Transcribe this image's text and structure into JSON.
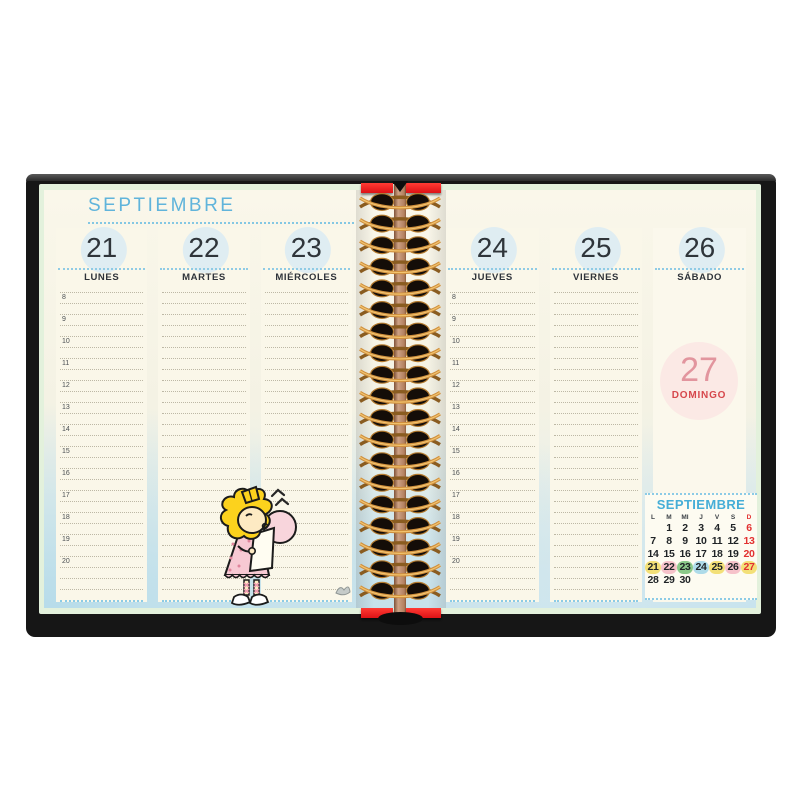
{
  "month_title": "SEPTIEMBRE",
  "left_page": {
    "days": [
      {
        "number": "21",
        "name": "LUNES",
        "has_rules": true,
        "shows_hours": true
      },
      {
        "number": "22",
        "name": "MARTES",
        "has_rules": true,
        "shows_hours": false
      },
      {
        "number": "23",
        "name": "MIÉRCOLES",
        "has_rules": true,
        "shows_hours": false
      }
    ]
  },
  "right_page": {
    "days": [
      {
        "number": "24",
        "name": "JUEVES",
        "has_rules": true,
        "shows_hours": true
      },
      {
        "number": "25",
        "name": "VIERNES",
        "has_rules": true,
        "shows_hours": false
      },
      {
        "number": "26",
        "name": "SÁBADO",
        "has_rules": false,
        "shows_hours": false
      }
    ],
    "sunday": {
      "number": "27",
      "name": "DOMINGO"
    }
  },
  "hours": [
    "8",
    "9",
    "10",
    "11",
    "12",
    "13",
    "14",
    "15",
    "16",
    "17",
    "18",
    "19",
    "20"
  ],
  "mini_calendar": {
    "title": "SEPTIEMBRE",
    "weekday_headers": [
      "L",
      "M",
      "MI",
      "J",
      "V",
      "S",
      "D"
    ],
    "weeks": [
      [
        "",
        "1",
        "2",
        "3",
        "4",
        "5",
        "6"
      ],
      [
        "7",
        "8",
        "9",
        "10",
        "11",
        "12",
        "13"
      ],
      [
        "14",
        "15",
        "16",
        "17",
        "18",
        "19",
        "20"
      ],
      [
        "21",
        "22",
        "23",
        "24",
        "25",
        "26",
        "27"
      ],
      [
        "28",
        "29",
        "30",
        "",
        "",
        "",
        ""
      ]
    ],
    "highlights": {
      "21": "yellow",
      "22": "pink",
      "23": "green",
      "24": "blue",
      "25": "yellow",
      "26": "pink",
      "27": "yellow"
    }
  },
  "colors": {
    "accent_blue": "#5fb3da",
    "sunday_red": "#e23030",
    "highlight_yellow": "#f3e078",
    "highlight_pink": "#f6c2ca",
    "highlight_green": "#8bc98a",
    "highlight_blue": "#aedbe9",
    "domingo_circle_bg": "#fbe9e5",
    "domingo_number": "#e2959e",
    "domingo_label": "#d6474c",
    "spiral_wire": "#cf8f3d",
    "cover_black": "#161616",
    "red_accent": "#e61e20"
  },
  "artwork": {
    "character": "sally-brown-blowing-bubble-gum"
  }
}
